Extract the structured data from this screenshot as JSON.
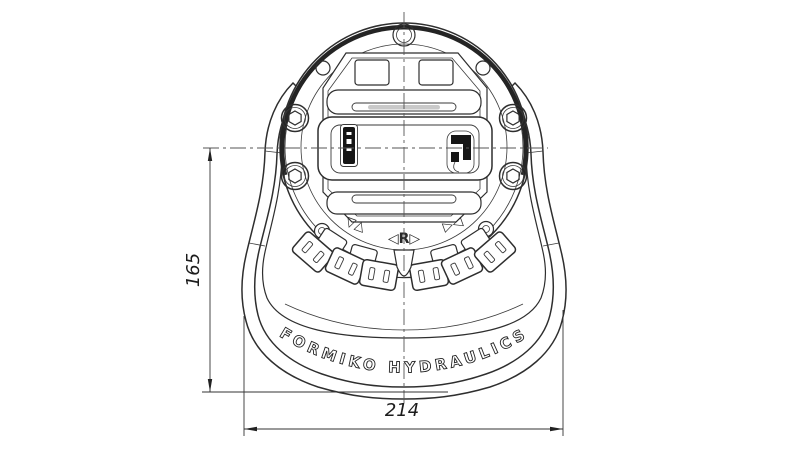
{
  "drawing": {
    "type": "technical-drawing",
    "view": "hydraulic foot pedal valve, top view",
    "background_color": "#ffffff",
    "line_color": "#2e2e2e",
    "centerline_color": "#555555",
    "brand": {
      "arc_text": "FORMIKO HYDRAULICS"
    },
    "dimensions": {
      "height": {
        "value": "165"
      },
      "width": {
        "value": "214"
      }
    },
    "markings": {
      "left": "▽△",
      "center": "◁R▷",
      "right": "▷◁"
    }
  }
}
